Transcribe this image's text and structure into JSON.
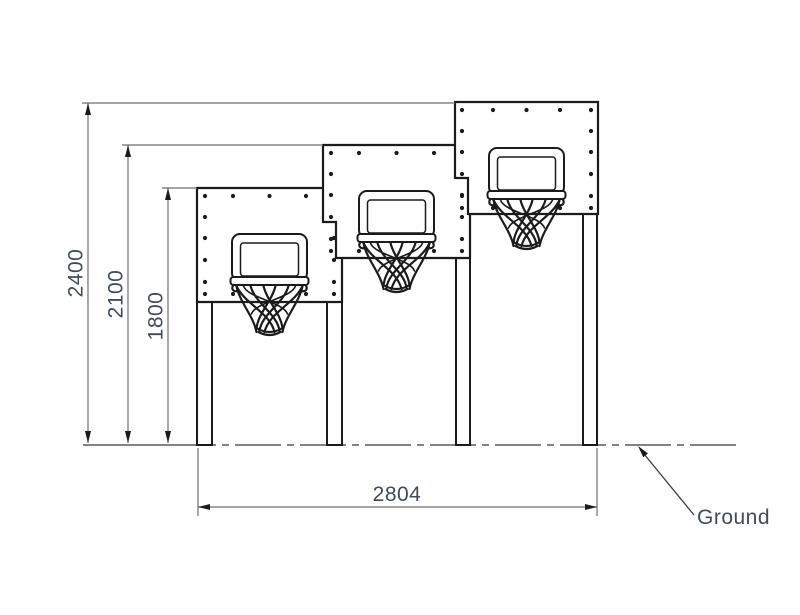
{
  "diagram": {
    "type": "technical elevation drawing",
    "subject": "triple basketball backboard unit at three heights"
  },
  "dimensions": {
    "tall_hoop_height": "2400",
    "middle_hoop_height": "2100",
    "low_hoop_height": "1800",
    "overall_width": "2804"
  },
  "labels": {
    "ground": "Ground"
  },
  "counts": {
    "backboards": 3,
    "posts": 4
  },
  "colors": {
    "line": "#1b1b1b",
    "thin_line": "#6e6e6e",
    "text": "#414a5e",
    "background": "#ffffff"
  }
}
